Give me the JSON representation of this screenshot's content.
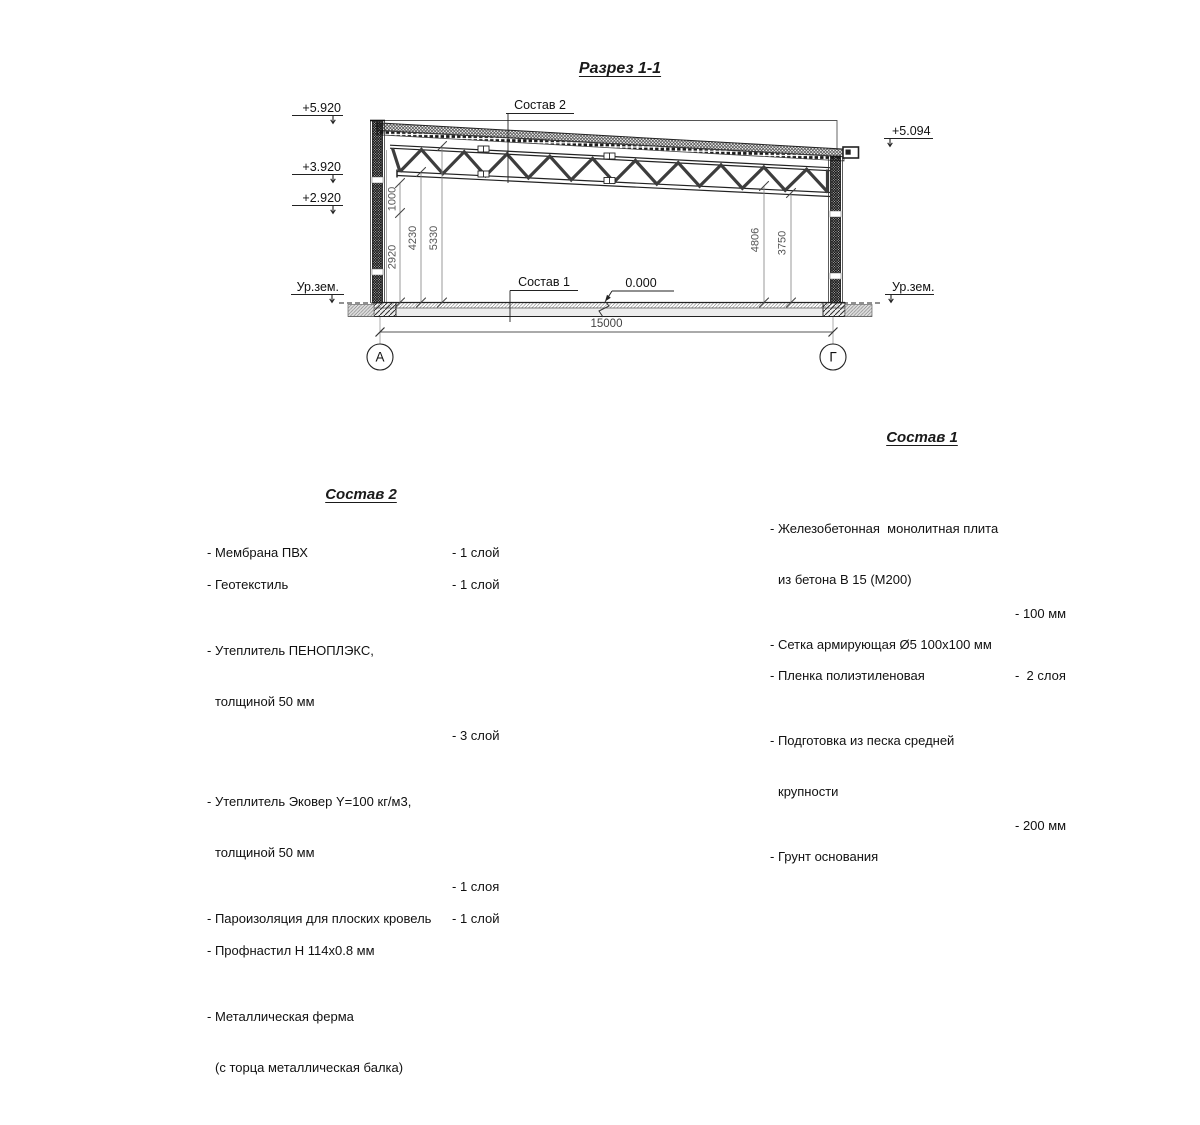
{
  "title": "Разрез 1-1",
  "drawing": {
    "elev_5920": "+5.920",
    "elev_3920": "+3.920",
    "elev_2920": "+2.920",
    "elev_5094": "+5.094",
    "elev_zero": "0.000",
    "ground_left": "Ур.зем.",
    "ground_right": "Ур.зем.",
    "leader_roof": "Состав 2",
    "leader_floor": "Состав 1",
    "dim_1000": "1000",
    "dim_2920": "2920",
    "dim_4230": "4230",
    "dim_5330": "5330",
    "dim_4806": "4806",
    "dim_3750": "3750",
    "dim_span": "15000",
    "axis_left": "А",
    "axis_right": "Г"
  },
  "sostav2": {
    "heading": "Состав 2",
    "items": [
      {
        "l1": "- Мембрана ПВХ",
        "value": "- 1 слой"
      },
      {
        "l1": "- Геотекстиль",
        "value": "- 1 слой"
      },
      {
        "l1": "- Утеплитель ПЕНОПЛЭКС,",
        "l2": "толщиной 50 мм",
        "value": "- 3 слой"
      },
      {
        "l1": "- Утеплитель Эковер Y=100 кг/м3,",
        "l2": "толщиной 50 мм",
        "value": "- 1 слоя"
      },
      {
        "l1": "- Пароизоляция для плоских кровель",
        "value": "- 1 слой"
      },
      {
        "l1": "- Профнастил Н 114х0.8 мм"
      },
      {
        "l1": "- Металлическая ферма",
        "l2": "(с торца металлическая балка)"
      }
    ]
  },
  "sostav1": {
    "heading": "Состав 1",
    "items": [
      {
        "l1": "- Железобетонная  монолитная плита",
        "l2": "из бетона В 15 (М200)",
        "value": "- 100 мм"
      },
      {
        "l1": "- Сетка армирующая Ø5 100х100 мм"
      },
      {
        "l1": "- Пленка полиэтиленовая",
        "value": "-  2 слоя"
      },
      {
        "l1": "- Подготовка из песка средней",
        "l2": "крупности",
        "value": "- 200 мм"
      },
      {
        "l1": "- Грунт основания"
      }
    ]
  }
}
